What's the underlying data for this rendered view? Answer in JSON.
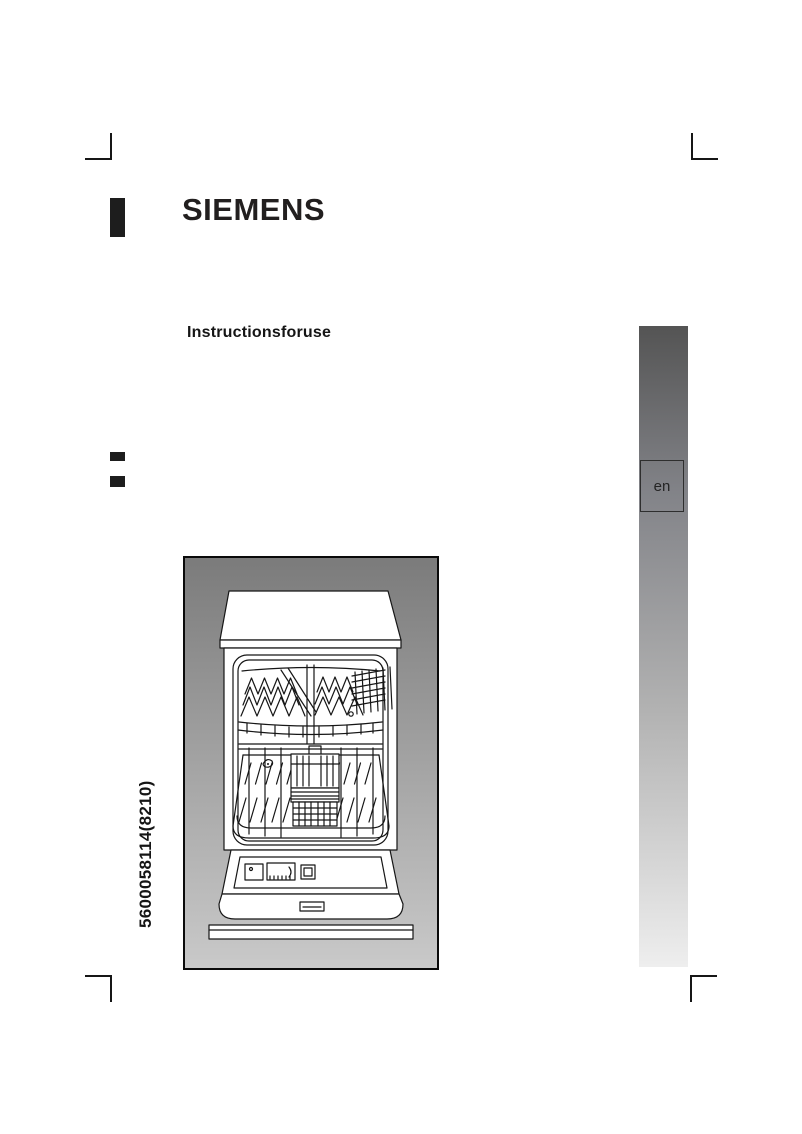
{
  "document": {
    "brand": "SIEMENS",
    "title": "Instructionsforuse",
    "part_number": "5600058114(8210)",
    "language_code": "en"
  },
  "figure": {
    "description": "dishwasher-open-front-line-drawing"
  },
  "colors": {
    "ink": "#161616",
    "logo_black": "#1d1d1d",
    "sidebar_gradient_top": "#545454",
    "sidebar_gradient_bottom": "#eeeeee",
    "figure_gradient_top": "#7b7b7b",
    "figure_gradient_bottom": "#c9c9c9"
  }
}
